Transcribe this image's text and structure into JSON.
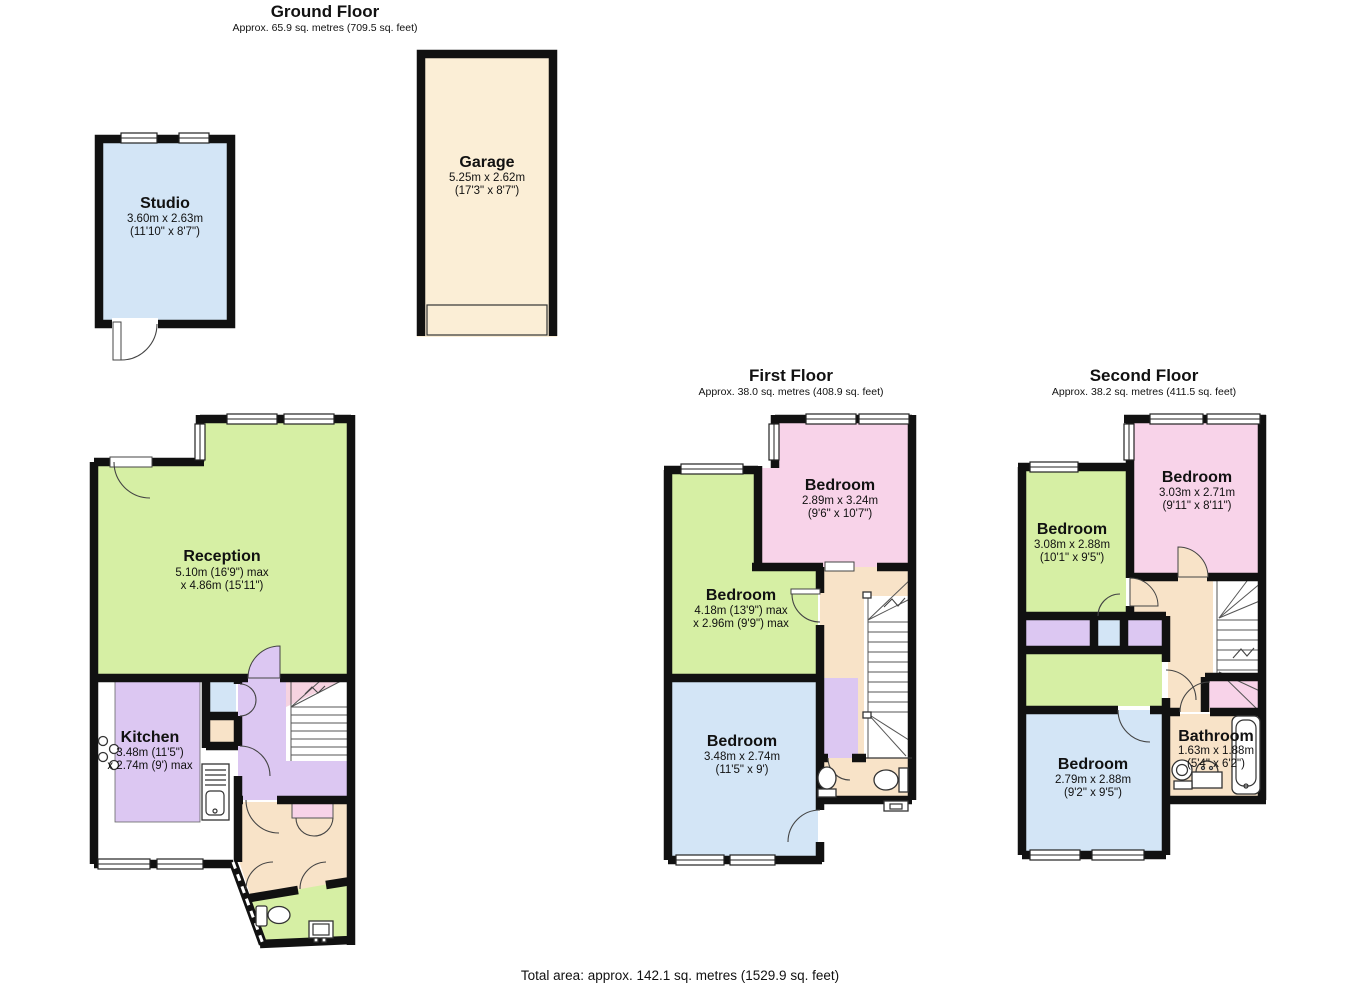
{
  "page": {
    "background": "#ffffff"
  },
  "palette": {
    "wall": "#111111",
    "room_blue": "#d3e5f6",
    "room_green": "#d6efa4",
    "room_pink": "#f8d3e9",
    "hall_purple": "#dcc7f2",
    "landing_cream": "#f8e3c8",
    "garage_cream": "#fbeed6",
    "understairs_pink": "#f6d3e0"
  },
  "floors": {
    "ground": {
      "title": "Ground Floor",
      "subtitle": "Approx. 65.9 sq. metres (709.5 sq. feet)"
    },
    "first": {
      "title": "First Floor",
      "subtitle": "Approx. 38.0 sq. metres (408.9 sq. feet)"
    },
    "second": {
      "title": "Second Floor",
      "subtitle": "Approx. 38.2 sq. metres (411.5 sq. feet)"
    }
  },
  "rooms": {
    "studio": {
      "name": "Studio",
      "dims_metric": "3.60m x 2.63m",
      "dims_imperial": "(11'10\" x 8'7\")"
    },
    "garage": {
      "name": "Garage",
      "dims_metric": "5.25m x 2.62m",
      "dims_imperial": "(17'3\" x 8'7\")"
    },
    "reception": {
      "name": "Reception",
      "dims_metric": "5.10m (16'9\") max",
      "dims_imperial": "x 4.86m (15'11\")"
    },
    "kitchen": {
      "name": "Kitchen",
      "dims_metric": "3.48m (11'5\")",
      "dims_imperial": "x 2.74m (9') max"
    },
    "ff_bedroom_top": {
      "name": "Bedroom",
      "dims_metric": "2.89m x 3.24m",
      "dims_imperial": "(9'6\" x 10'7\")"
    },
    "ff_bedroom_mid": {
      "name": "Bedroom",
      "dims_metric": "4.18m (13'9\") max",
      "dims_imperial": "x 2.96m (9'9\") max"
    },
    "ff_bedroom_bottom": {
      "name": "Bedroom",
      "dims_metric": "3.48m x 2.74m",
      "dims_imperial": "(11'5\" x 9')"
    },
    "sf_bedroom_top": {
      "name": "Bedroom",
      "dims_metric": "3.03m x 2.71m",
      "dims_imperial": "(9'11\" x 8'11\")"
    },
    "sf_bedroom_left": {
      "name": "Bedroom",
      "dims_metric": "3.08m x 2.88m",
      "dims_imperial": "(10'1\" x 9'5\")"
    },
    "sf_bedroom_bottom": {
      "name": "Bedroom",
      "dims_metric": "2.79m x 2.88m",
      "dims_imperial": "(9'2\" x 9'5\")"
    },
    "sf_bathroom": {
      "name": "Bathroom",
      "dims_metric": "1.63m x 1.88m",
      "dims_imperial": "(5'4\" x 6'2\")"
    }
  },
  "footer": {
    "total_area": "Total area: approx. 142.1 sq. metres (1529.9 sq. feet)"
  }
}
